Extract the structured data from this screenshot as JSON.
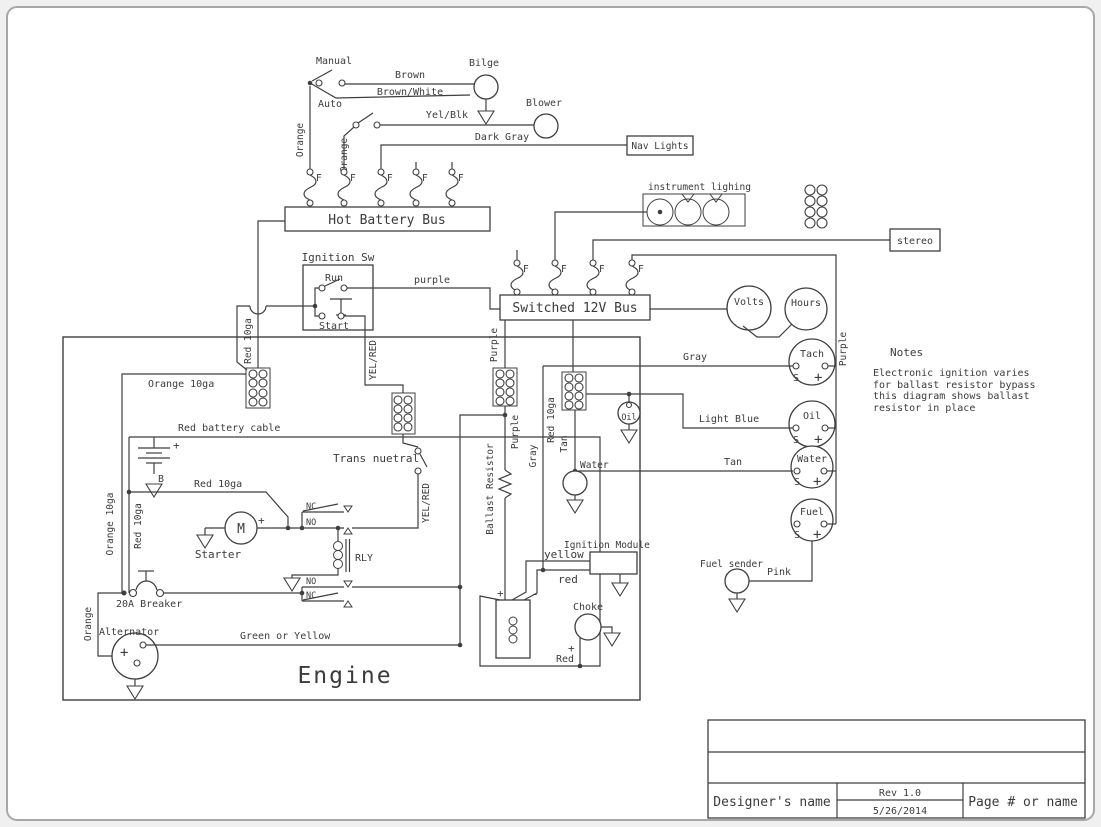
{
  "colors": {
    "line": "#3f3f3f",
    "page_bg": "#f0f0f0",
    "canvas_bg": "#ffffff",
    "frame": "#a8a8a8"
  },
  "top": {
    "manual": "Manual",
    "auto": "Auto",
    "brown": "Brown",
    "brown_white": "Brown/White",
    "bilge": "Bilge",
    "blower": "Blower",
    "yel_blk": "Yel/Blk",
    "dark_gray": "Dark Gray",
    "nav_lights": "Nav Lights",
    "orange": "Orange",
    "fuse": "F",
    "hot_bus": "Hot Battery Bus"
  },
  "ignition": {
    "title": "Ignition Sw",
    "run": "Run",
    "start": "Start",
    "purple": "purple"
  },
  "switched": {
    "bus": "Switched 12V Bus",
    "instrument_lighting": "instrument lighing",
    "stereo": "stereo"
  },
  "gauges": {
    "volts": "Volts",
    "hours": "Hours",
    "tach": "Tach",
    "oil": "Oil",
    "water": "Water",
    "fuel": "Fuel",
    "s": "S",
    "plus": "+"
  },
  "wire_labels": {
    "gray": "Gray",
    "light_blue": "Light Blue",
    "tan": "Tan",
    "purple": "Purple",
    "pink": "Pink",
    "green_or_yellow": "Green or Yellow",
    "yel_red": "YEL/RED",
    "yellow": "yellow",
    "red_lc": "red",
    "red": "Red",
    "orange_10ga": "Orange 10ga",
    "red_10ga": "Red 10ga",
    "red_battery_cable": "Red battery cable"
  },
  "engine": {
    "label": "Engine",
    "trans_neutral": "Trans nuetral",
    "nc": "NC",
    "no": "NO",
    "rly": "RLY",
    "starter": "Starter",
    "motor": "M",
    "plus": "+",
    "minus": "-",
    "battery_b": "B",
    "breaker": "20A Breaker",
    "alternator": "Alternator",
    "ballast": "Ballast Resistor",
    "ignition_module": "Ignition Module",
    "choke": "Choke",
    "oil_sender": "Oil",
    "water_sender": "Water",
    "fuel_sender": "Fuel sender"
  },
  "notes": {
    "title": "Notes",
    "line1": "Electronic ignition varies",
    "line2": "for ballast resistor bypass",
    "line3": "this diagram shows ballast",
    "line4": "resistor in place"
  },
  "title_block": {
    "designer": "Designer's name",
    "rev": "Rev 1.0",
    "date": "5/26/2014",
    "page": "Page # or name"
  }
}
